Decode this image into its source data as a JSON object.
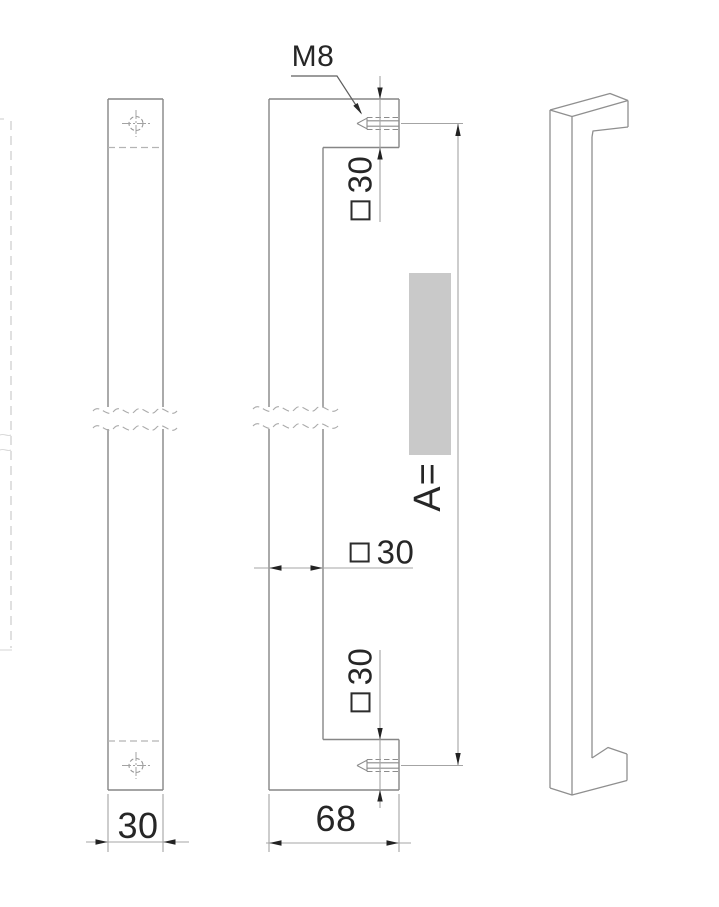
{
  "page": {
    "background": "#ffffff",
    "kind": "technical drawing, square door pull handle, 3 views"
  },
  "colors": {
    "outline": "#868686",
    "dimension_line": "#a4a4a4",
    "hidden_line": "#b4b4b4",
    "center_line": "#a3a3a3",
    "arrow": "#222222",
    "text": "#262626",
    "highlight_box": "#c9c9c9"
  },
  "views": {
    "back_view": {
      "width_dim": "30",
      "section_symbol": "none"
    },
    "profile_view": {
      "thread_callout": "M8",
      "top_post_section": "30",
      "top_post_symbol": "square",
      "grip_width": "30",
      "grip_width_symbol": "square",
      "bottom_post_section": "30",
      "bottom_post_symbol": "square",
      "overall_length_label": "A=",
      "depth_dim": "68"
    },
    "iso_view": {
      "description": "perspective view of handle"
    }
  }
}
